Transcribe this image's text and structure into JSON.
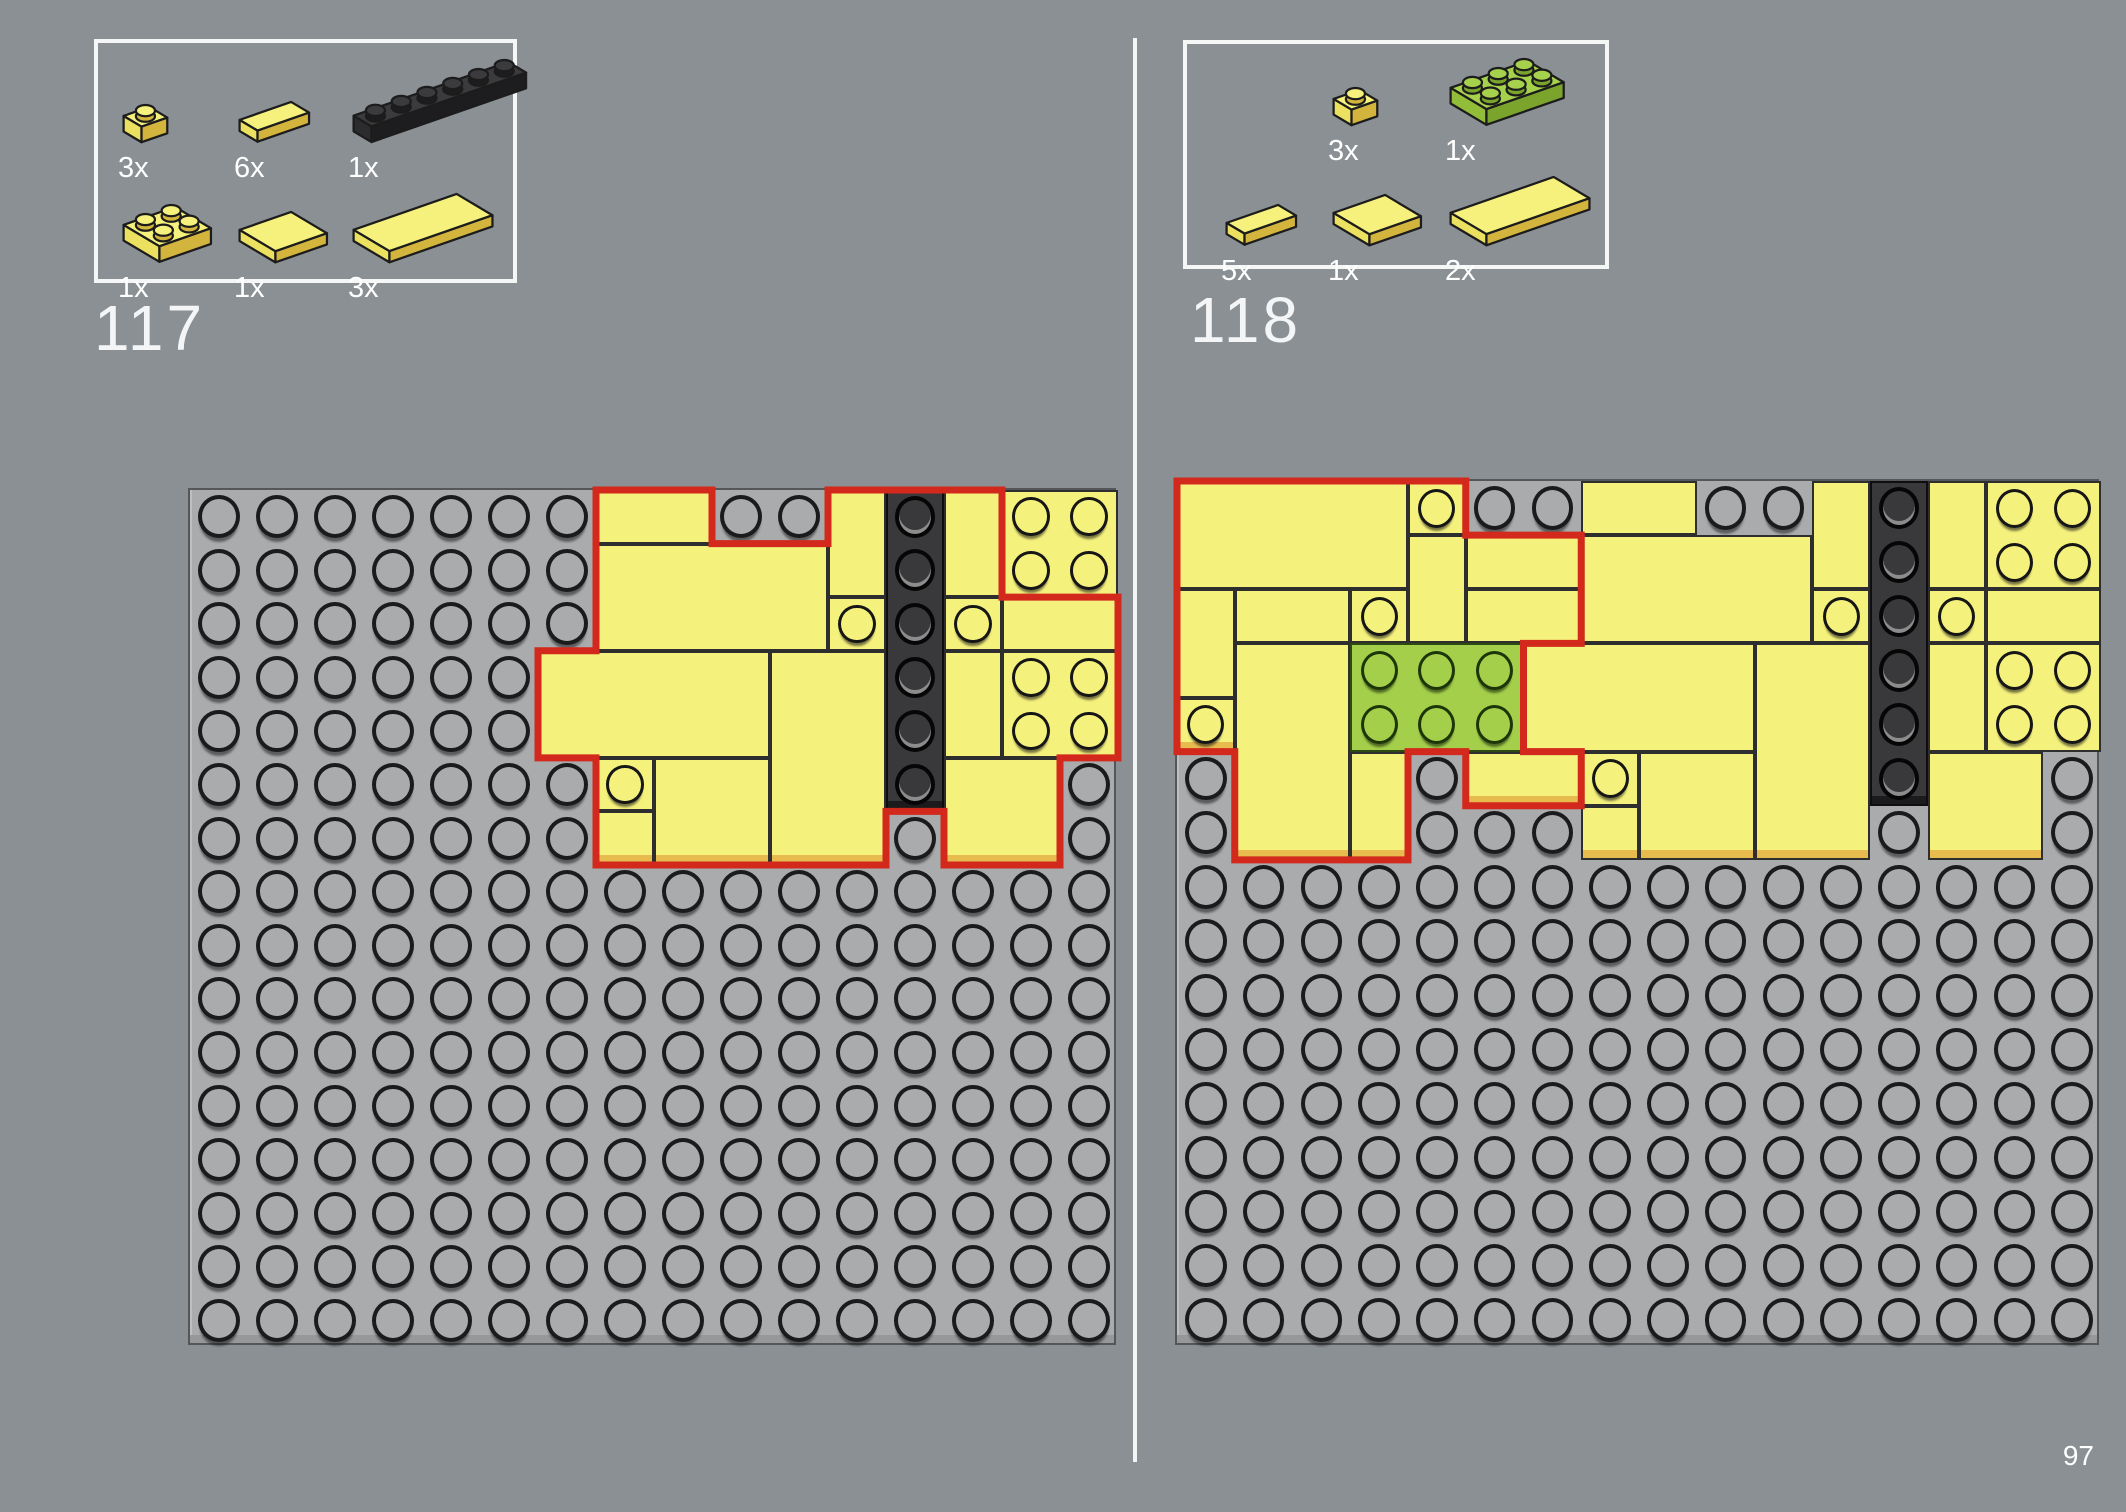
{
  "page": {
    "number": "97",
    "background_color": "#8a9094",
    "divider_color": "#f3f5f5",
    "red_outline_color": "#d2291c",
    "baseplate_color": "#a9abad",
    "yellow_color": "#f5f17d",
    "green_color": "#a3cf4b",
    "black_color": "#39393b"
  },
  "layout": {
    "divider": {
      "x": 1133,
      "y": 38,
      "w": 4,
      "h": 1424
    },
    "page_number_pos": {
      "x": 2046,
      "y": 1440,
      "w": 48
    }
  },
  "steps": [
    {
      "number": "117",
      "number_pos": {
        "x": 94,
        "y": 296
      },
      "parts_box": {
        "box": {
          "x": 94,
          "y": 39,
          "w": 423,
          "h": 244
        },
        "rows": [
          [
            {
              "icon": "plate-1x1-yellow",
              "count": "3x"
            },
            {
              "icon": "tile-1x2-yellow",
              "count": "6x"
            },
            {
              "icon": "plate-1x6-black",
              "count": "1x"
            }
          ],
          [
            {
              "icon": "plate-2x2-yellow",
              "count": "1x"
            },
            {
              "icon": "tile-2x2-yellow",
              "count": "1x"
            },
            {
              "icon": "tile-2x4-yellow",
              "count": "3x"
            }
          ]
        ]
      },
      "plate": {
        "x": 188,
        "y": 488,
        "w": 928,
        "h": 857,
        "cols": 16,
        "rows": 16,
        "pieces": [
          {
            "c": 8,
            "r": 1,
            "w": 2,
            "h": 1,
            "color": "yellow",
            "studs": false,
            "new": true
          },
          {
            "c": 12,
            "r": 1,
            "w": 1,
            "h": 2,
            "color": "yellow",
            "studs": false,
            "new": true
          },
          {
            "c": 13,
            "r": 1,
            "w": 1,
            "h": 6,
            "color": "black",
            "studs": true,
            "lip": true,
            "new": true
          },
          {
            "c": 14,
            "r": 1,
            "w": 1,
            "h": 2,
            "color": "yellow",
            "studs": false,
            "new": true
          },
          {
            "c": 15,
            "r": 1,
            "w": 2,
            "h": 2,
            "color": "yellow",
            "studs": true,
            "new": false
          },
          {
            "c": 8,
            "r": 2,
            "w": 4,
            "h": 2,
            "color": "yellow",
            "studs": false,
            "new": true
          },
          {
            "c": 12,
            "r": 3,
            "w": 1,
            "h": 1,
            "color": "yellow",
            "studs": true,
            "new": true
          },
          {
            "c": 14,
            "r": 3,
            "w": 1,
            "h": 1,
            "color": "yellow",
            "studs": true,
            "new": true
          },
          {
            "c": 15,
            "r": 3,
            "w": 2,
            "h": 1,
            "color": "yellow",
            "studs": false,
            "new": true
          },
          {
            "c": 7,
            "r": 4,
            "w": 4,
            "h": 2,
            "color": "yellow",
            "studs": false,
            "new": true
          },
          {
            "c": 11,
            "r": 4,
            "w": 2,
            "h": 4,
            "color": "yellow",
            "studs": false,
            "lip": true,
            "new": true
          },
          {
            "c": 14,
            "r": 4,
            "w": 1,
            "h": 2,
            "color": "yellow",
            "studs": false,
            "new": true
          },
          {
            "c": 15,
            "r": 4,
            "w": 2,
            "h": 2,
            "color": "yellow",
            "studs": true,
            "new": true
          },
          {
            "c": 8,
            "r": 6,
            "w": 1,
            "h": 1,
            "color": "yellow",
            "studs": true,
            "new": true
          },
          {
            "c": 8,
            "r": 7,
            "w": 1,
            "h": 1,
            "color": "yellow",
            "studs": false,
            "lip": true,
            "new": true
          },
          {
            "c": 9,
            "r": 6,
            "w": 2,
            "h": 2,
            "color": "yellow",
            "studs": false,
            "lip": true,
            "new": true
          },
          {
            "c": 14,
            "r": 6,
            "w": 2,
            "h": 2,
            "color": "yellow",
            "studs": false,
            "lip": true,
            "new": true
          }
        ],
        "red_outline": [
          [
            7,
            0
          ],
          [
            9,
            0
          ],
          [
            9,
            1
          ],
          [
            11,
            1
          ],
          [
            11,
            0
          ],
          [
            14,
            0
          ],
          [
            14,
            2
          ],
          [
            16,
            2
          ],
          [
            16,
            5
          ],
          [
            15,
            5
          ],
          [
            15,
            7
          ],
          [
            13,
            7
          ],
          [
            13,
            6
          ],
          [
            12,
            6
          ],
          [
            12,
            7
          ],
          [
            10,
            7
          ],
          [
            7,
            7
          ],
          [
            7,
            5
          ],
          [
            6,
            5
          ],
          [
            6,
            3
          ],
          [
            7,
            3
          ],
          [
            7,
            1
          ]
        ]
      }
    },
    {
      "number": "118",
      "number_pos": {
        "x": 1190,
        "y": 288
      },
      "parts_box": {
        "box": {
          "x": 1183,
          "y": 40,
          "w": 426,
          "h": 229
        },
        "rows": [
          [
            null,
            {
              "icon": "plate-1x1-yellow",
              "count": "3x"
            },
            {
              "icon": "plate-2x3-green",
              "count": "1x"
            }
          ],
          [
            {
              "icon": "tile-1x2-yellow",
              "count": "5x"
            },
            {
              "icon": "tile-2x2-yellow",
              "count": "1x"
            },
            {
              "icon": "tile-2x4-yellow",
              "count": "2x"
            }
          ]
        ]
      },
      "plate": {
        "x": 1175,
        "y": 479,
        "w": 924,
        "h": 866,
        "cols": 16,
        "rows": 16,
        "pieces": [
          {
            "c": 8,
            "r": 1,
            "w": 2,
            "h": 1,
            "color": "yellow",
            "studs": false,
            "new": false
          },
          {
            "c": 12,
            "r": 1,
            "w": 1,
            "h": 2,
            "color": "yellow",
            "studs": false,
            "new": false
          },
          {
            "c": 13,
            "r": 1,
            "w": 1,
            "h": 6,
            "color": "black",
            "studs": true,
            "lip": true,
            "new": false
          },
          {
            "c": 14,
            "r": 1,
            "w": 1,
            "h": 2,
            "color": "yellow",
            "studs": false,
            "new": false
          },
          {
            "c": 15,
            "r": 1,
            "w": 2,
            "h": 2,
            "color": "yellow",
            "studs": true,
            "new": false
          },
          {
            "c": 8,
            "r": 2,
            "w": 4,
            "h": 2,
            "color": "yellow",
            "studs": false,
            "new": false
          },
          {
            "c": 12,
            "r": 3,
            "w": 1,
            "h": 1,
            "color": "yellow",
            "studs": true,
            "new": false
          },
          {
            "c": 14,
            "r": 3,
            "w": 1,
            "h": 1,
            "color": "yellow",
            "studs": true,
            "new": false
          },
          {
            "c": 15,
            "r": 3,
            "w": 2,
            "h": 1,
            "color": "yellow",
            "studs": false,
            "new": false
          },
          {
            "c": 7,
            "r": 4,
            "w": 4,
            "h": 2,
            "color": "yellow",
            "studs": false,
            "new": false
          },
          {
            "c": 11,
            "r": 4,
            "w": 2,
            "h": 4,
            "color": "yellow",
            "studs": false,
            "lip": true,
            "new": false
          },
          {
            "c": 14,
            "r": 4,
            "w": 1,
            "h": 2,
            "color": "yellow",
            "studs": false,
            "new": false
          },
          {
            "c": 15,
            "r": 4,
            "w": 2,
            "h": 2,
            "color": "yellow",
            "studs": true,
            "new": false
          },
          {
            "c": 8,
            "r": 6,
            "w": 1,
            "h": 1,
            "color": "yellow",
            "studs": true,
            "new": false
          },
          {
            "c": 8,
            "r": 7,
            "w": 1,
            "h": 1,
            "color": "yellow",
            "studs": false,
            "lip": true,
            "new": false
          },
          {
            "c": 9,
            "r": 6,
            "w": 2,
            "h": 2,
            "color": "yellow",
            "studs": false,
            "lip": true,
            "new": false
          },
          {
            "c": 14,
            "r": 6,
            "w": 2,
            "h": 2,
            "color": "yellow",
            "studs": false,
            "lip": true,
            "new": false
          },
          {
            "c": 1,
            "r": 1,
            "w": 4,
            "h": 2,
            "color": "yellow",
            "studs": false,
            "new": true
          },
          {
            "c": 5,
            "r": 1,
            "w": 1,
            "h": 1,
            "color": "yellow",
            "studs": true,
            "new": true
          },
          {
            "c": 5,
            "r": 2,
            "w": 1,
            "h": 2,
            "color": "yellow",
            "studs": false,
            "new": true
          },
          {
            "c": 6,
            "r": 2,
            "w": 2,
            "h": 1,
            "color": "yellow",
            "studs": false,
            "new": true
          },
          {
            "c": 6,
            "r": 3,
            "w": 2,
            "h": 1,
            "color": "yellow",
            "studs": false,
            "new": true
          },
          {
            "c": 1,
            "r": 3,
            "w": 1,
            "h": 2,
            "color": "yellow",
            "studs": false,
            "new": true
          },
          {
            "c": 1,
            "r": 5,
            "w": 1,
            "h": 1,
            "color": "yellow",
            "studs": true,
            "lip": true,
            "new": true
          },
          {
            "c": 2,
            "r": 3,
            "w": 2,
            "h": 1,
            "color": "yellow",
            "studs": false,
            "new": true
          },
          {
            "c": 2,
            "r": 4,
            "w": 2,
            "h": 4,
            "color": "yellow",
            "studs": false,
            "lip": true,
            "new": true
          },
          {
            "c": 4,
            "r": 3,
            "w": 1,
            "h": 1,
            "color": "yellow",
            "studs": true,
            "new": true
          },
          {
            "c": 4,
            "r": 4,
            "w": 3,
            "h": 2,
            "color": "green",
            "studs": true,
            "new": true
          },
          {
            "c": 4,
            "r": 6,
            "w": 1,
            "h": 2,
            "color": "yellow",
            "studs": false,
            "lip": true,
            "new": true
          },
          {
            "c": 6,
            "r": 6,
            "w": 2,
            "h": 1,
            "color": "yellow",
            "studs": false,
            "lip": true,
            "new": true
          }
        ],
        "red_outline": [
          [
            0,
            0
          ],
          [
            5,
            0
          ],
          [
            5,
            1
          ],
          [
            7,
            1
          ],
          [
            7,
            3
          ],
          [
            6,
            3
          ],
          [
            6,
            5
          ],
          [
            7,
            5
          ],
          [
            7,
            6
          ],
          [
            5,
            6
          ],
          [
            5,
            5
          ],
          [
            4,
            5
          ],
          [
            4,
            7
          ],
          [
            1,
            7
          ],
          [
            1,
            5
          ],
          [
            0,
            5
          ]
        ]
      }
    }
  ]
}
